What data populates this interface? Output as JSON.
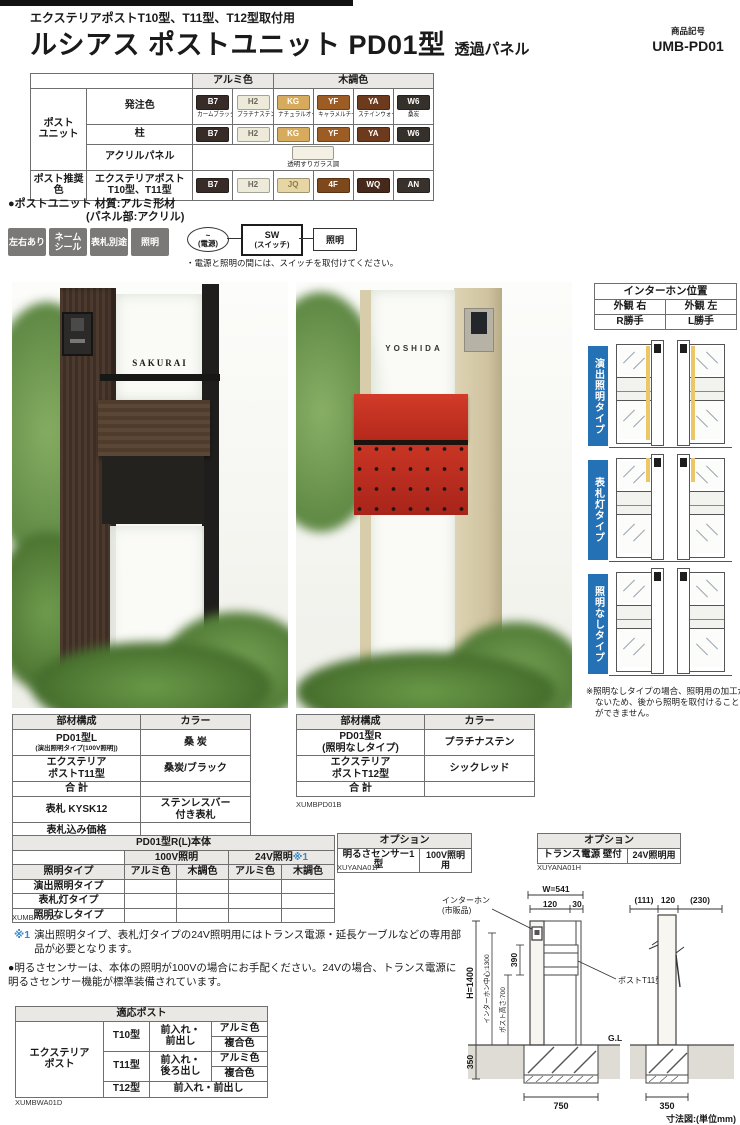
{
  "header": {
    "subtitle": "エクステリアポストT10型、T11型、T12型取付用",
    "title": "ルシアス ポストユニット PD01型",
    "title_suffix": "透過パネル",
    "product_code_label": "商品記号",
    "product_code": "UMB-PD01"
  },
  "color_table": {
    "group_aluminum": "アルミ色",
    "group_wood": "木調色",
    "row_post_unit": "ポスト\nユニット",
    "row_order_color": "発注色",
    "row_pillar": "柱",
    "row_acrylic": "アクリルパネル",
    "row_recommended": "ポスト推奨色",
    "row_exterior_post": "エクステリアポスト\nT10型、T11型",
    "acrylic_chip": {
      "label": "透明すりガラス調",
      "hex": "#f4f1e4"
    },
    "order_colors": [
      {
        "code": "B7",
        "name": "カームブラック",
        "hex": "#372c28",
        "text": "#ffffff"
      },
      {
        "code": "H2",
        "name": "プラチナステン",
        "hex": "#edead9",
        "text": "#6a675d"
      },
      {
        "code": "KG",
        "name": "ナチュラルオーク",
        "hex": "#d6ab5e",
        "text": "#ffffff"
      },
      {
        "code": "YF",
        "name": "キャラメルチーク",
        "hex": "#9c5c24",
        "text": "#ffffff"
      },
      {
        "code": "YA",
        "name": "ステインウォールナット",
        "hex": "#6e3a1e",
        "text": "#ffffff"
      },
      {
        "code": "W6",
        "name": "桑炭",
        "hex": "#36302a",
        "text": "#ffffff"
      }
    ],
    "pillar_colors": [
      {
        "code": "B7",
        "hex": "#372c28",
        "text": "#ffffff"
      },
      {
        "code": "H2",
        "hex": "#edead9",
        "text": "#6a675d"
      },
      {
        "code": "KG",
        "hex": "#d6ab5e",
        "text": "#ffffff"
      },
      {
        "code": "YF",
        "hex": "#9c5c24",
        "text": "#ffffff"
      },
      {
        "code": "YA",
        "hex": "#6e3a1e",
        "text": "#ffffff"
      },
      {
        "code": "W6",
        "hex": "#36302a",
        "text": "#ffffff"
      }
    ],
    "recommended_colors": [
      {
        "code": "B7",
        "hex": "#372c28",
        "text": "#ffffff"
      },
      {
        "code": "H2",
        "hex": "#edead9",
        "text": "#6a675d"
      },
      {
        "code": "JQ",
        "hex": "#e6d6a4",
        "text": "#8d7b4e"
      },
      {
        "code": "4F",
        "hex": "#7c481c",
        "text": "#ffffff"
      },
      {
        "code": "WQ",
        "hex": "#47291b",
        "text": "#ffffff"
      },
      {
        "code": "AN",
        "hex": "#39322c",
        "text": "#ffffff"
      }
    ]
  },
  "material_note": {
    "line1": "●ポストユニット 材質:アルミ形材",
    "line2": "(パネル部:アクリル)"
  },
  "features": {
    "badges": [
      {
        "label": "左右あり"
      },
      {
        "label": "ネーム\nシール"
      },
      {
        "label": "表札別途"
      },
      {
        "label": "照明"
      }
    ],
    "circuit": {
      "tilde": "~",
      "power": "(電源)",
      "switch_line1": "SW",
      "switch_line2": "(スイッチ)",
      "light": "照明",
      "note": "・電源と照明の間には、スイッチを取付けてください。"
    }
  },
  "photos": {
    "left_nameplate": "SAKURAI",
    "right_nameplate": "YOSHIDA"
  },
  "intercom_table": {
    "title": "インターホン位置",
    "r1c1": "外観 右",
    "r1c2": "外観 左",
    "r2c1": "R勝手",
    "r2c2": "L勝手"
  },
  "type_sections": [
    {
      "label": "演出照明タイプ"
    },
    {
      "label": "表札灯タイプ"
    },
    {
      "label": "照明なしタイプ"
    }
  ],
  "type_note": "※照明なしタイプの場合、照明用の加工がないため、後から照明を取付けることができません。",
  "parts_left": {
    "h1": "部材構成",
    "h2": "カラー",
    "rows": [
      {
        "name": "PD01型L",
        "name_sub": "(演出照明タイプ[100V照明])",
        "color": "桑 炭"
      },
      {
        "name": "エクステリア\nポストT11型",
        "name_sub": "",
        "color": "桑炭/ブラック"
      },
      {
        "name": "合 計",
        "name_sub": "",
        "color": ""
      },
      {
        "name": "表札 KYSK12",
        "name_sub": "",
        "color": "ステンレスバー\n付き表札"
      },
      {
        "name": "表札込み価格",
        "name_sub": "",
        "color": ""
      }
    ],
    "caption": "XUMBPD01A"
  },
  "parts_right": {
    "h1": "部材構成",
    "h2": "カラー",
    "rows": [
      {
        "name": "PD01型R\n(照明なしタイプ)",
        "color": "プラチナステン"
      },
      {
        "name": "エクステリア\nポストT12型",
        "color": "シックレッド"
      },
      {
        "name": "合 計",
        "color": ""
      }
    ],
    "caption": "XUMBPD01B"
  },
  "body_table": {
    "title": "PD01型R(L)本体",
    "col_100v": "100V照明",
    "col_24v": "24V照明",
    "col_24v_mark": "※1",
    "col_type": "照明タイプ",
    "col_aluminum": "アルミ色",
    "col_wood": "木調色",
    "rows": [
      "演出照明タイプ",
      "表札灯タイプ",
      "照明なしタイプ"
    ],
    "caption": "XUMBPD01C"
  },
  "options": [
    {
      "title": "オプション",
      "name": "明るさセンサー1型",
      "use": "100V照明用",
      "caption": "XUYANA01F"
    },
    {
      "title": "オプション",
      "name": "トランス電源 壁付",
      "use": "24V照明用",
      "caption": "XUYANA01H"
    }
  ],
  "notes": {
    "note1_mark": "※1",
    "note1": "演出照明タイプ、表札灯タイプの24V照明用にはトランス電源・延長ケーブルなどの専用部品が必要となります。",
    "note2": "●明るさセンサーは、本体の照明が100Vの場合にお手配ください。24Vの場合、トランス電源に明るさセンサー機能が標準装備されています。"
  },
  "compat_table": {
    "title": "適応ポスト",
    "group": "エクステリア\nポスト",
    "rows": [
      {
        "model": "T10型",
        "access": "前入れ・\n前出し",
        "colors": [
          "アルミ色",
          "複合色"
        ]
      },
      {
        "model": "T11型",
        "access": "前入れ・\n後ろ出し",
        "colors": [
          "アルミ色",
          "複合色"
        ]
      },
      {
        "model": "T12型",
        "access": "前入れ・前出し",
        "colors": []
      }
    ],
    "caption": "XUMBWA01D"
  },
  "dimensions": {
    "w": "W=541",
    "d120a": "120",
    "d30": "30",
    "d111": "(111)",
    "d120b": "120",
    "d230": "(230)",
    "h": "H=1400",
    "d390": "390",
    "d350": "350",
    "d750": "750",
    "d350b": "350",
    "intercom_center": "インターホン中心:1300",
    "post_height": "ポスト高さ:700",
    "intercom_label1": "インターホン",
    "intercom_label2": "(市販品)",
    "post_label": "ポストT11型",
    "gl": "G.L",
    "caption": "寸法図:(単位mm)"
  },
  "colors": {
    "accent_blue": "#2472b5",
    "badge_gray": "#7b7977",
    "chic_red": "#c8281e"
  }
}
